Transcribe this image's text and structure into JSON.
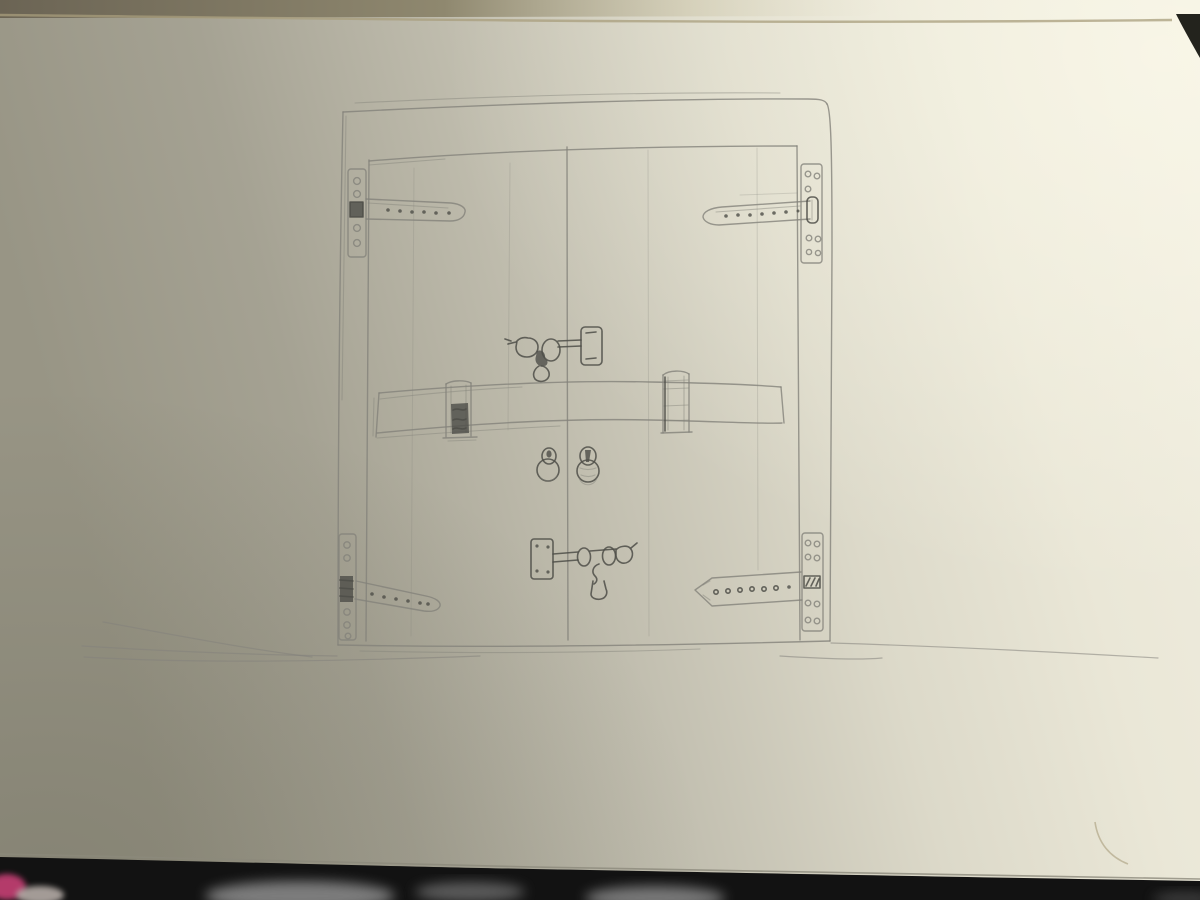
{
  "meta": {
    "title": "Photograph of a graphite pencil sketch in a sketchbook showing a pair of wooden double doors with strap hinges, a horizontal locking cross-bar in brackets, two hasp latches and two ring pulls, drawn above a ground line",
    "medium": "pencil on cream sketchbook paper",
    "lighting": "window light from the upper right, left side of the page in soft shadow, dark table gap visible at the bottom and top-right corner"
  },
  "colors": {
    "paper-shadow": "#989585",
    "paper-mid": "#cfccbc",
    "paper-bright": "#f0eddf",
    "top-band": "#6b6454",
    "crease-line": "#a89d7c",
    "corner-gap": "#23231d",
    "bottom-gap": "#121212",
    "fabric-gray": "#8f8f8f",
    "fabric-light": "#bdb4ae",
    "pink-object": "#b43a6b",
    "pencil": "#83827b",
    "pencil-dark": "#4e4e48",
    "paper-edge": "#8c897c"
  },
  "sketch": {
    "subject": "double barn-style doors, front elevation",
    "elements": [
      {
        "name": "door-frame",
        "desc": "large square outer frame"
      },
      {
        "name": "door-panels",
        "desc": "two door leaves split by a center line with faint plank lines"
      },
      {
        "name": "hinge-top-left",
        "desc": "T strap hinge, vertical screw plate with holes, riveted strap pointing right"
      },
      {
        "name": "hinge-top-right",
        "desc": "mirrored strap hinge pointing left with screw plate"
      },
      {
        "name": "hinge-bottom-left",
        "desc": "strap hinge angled slightly down with dark knuckle"
      },
      {
        "name": "hinge-bottom-right",
        "desc": "mirrored strap hinge with hatched pin slot"
      },
      {
        "name": "cross-bar",
        "desc": "long horizontal wooden locking bar resting in two brackets"
      },
      {
        "name": "bar-bracket-left",
        "desc": "bracket with dark shaded lower half"
      },
      {
        "name": "bar-bracket-right",
        "desc": "open bracket with tab above the bar"
      },
      {
        "name": "upper-hasp-latch",
        "desc": "hasp with knob, eye loop, keeper plate and hanging pin above the bar"
      },
      {
        "name": "ring-pull-left",
        "desc": "small ring pull handle"
      },
      {
        "name": "ring-pull-right",
        "desc": "small ring pull handle, darker"
      },
      {
        "name": "lower-hasp-latch",
        "desc": "mirrored hasp latch below center with hanging pin"
      },
      {
        "name": "ground-line",
        "desc": "long wavy baseline across the page"
      },
      {
        "name": "page-curl",
        "desc": "faint curled corner mark near bottom right"
      }
    ]
  }
}
